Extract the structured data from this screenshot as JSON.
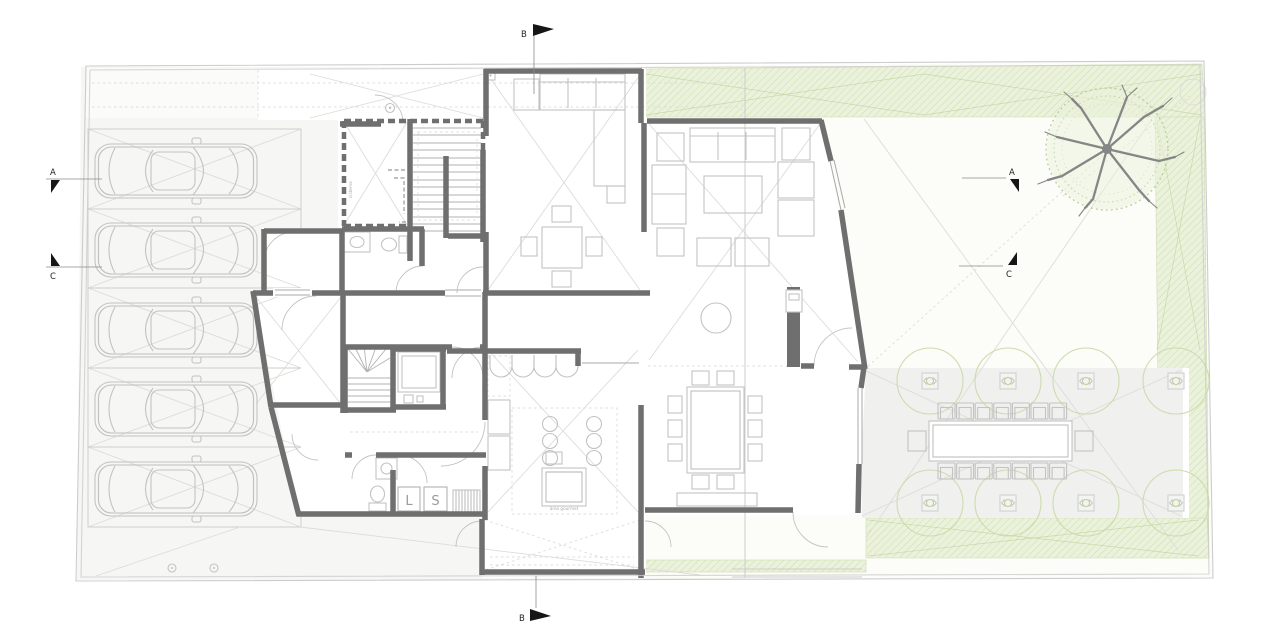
{
  "drawing": {
    "kind": "architectural ground-floor site plan",
    "description": "Two-unit residence with street parking strip, interior rooms, rear garden with tree and outdoor dining terrace",
    "canvas": {
      "width": 1280,
      "height": 640
    }
  },
  "colors": {
    "wall": "#6f6f6f",
    "wall_light": "#a8a8a8",
    "furniture": "#c3c3c3",
    "furniture_dark": "#b2b2b2",
    "faint": "#dcdcd8",
    "site_line": "#cccccc",
    "paving": "#f0f0ee",
    "paving_zone": "#f6f6f4",
    "paving_stalls": "#f1f1ef",
    "sidewalk": "#fbfbf9",
    "lawn": "#fcfcf8",
    "green_fill": "#ebf2dc",
    "green_line": "#ccdcae",
    "green_dark": "#b7cd92",
    "tree_branch": "#868686",
    "marker": "#161616",
    "text": "#9a9a9a"
  },
  "markers": {
    "section_a_left": "A",
    "section_c_left": "C",
    "section_a_right": "A",
    "section_c_right": "C",
    "section_b_top": "B",
    "section_b_bottom": "B"
  },
  "labels": {
    "washer": "L",
    "dryer": "S",
    "cistern_room": "cisterna",
    "island_note": "área gourmet"
  },
  "counts": {
    "parking_spaces": 5,
    "breakfast_table_seats": 4,
    "dining_table_seats": 10,
    "outdoor_table_seats": 16,
    "terrace_planters": 8,
    "garden_trees": 1
  }
}
